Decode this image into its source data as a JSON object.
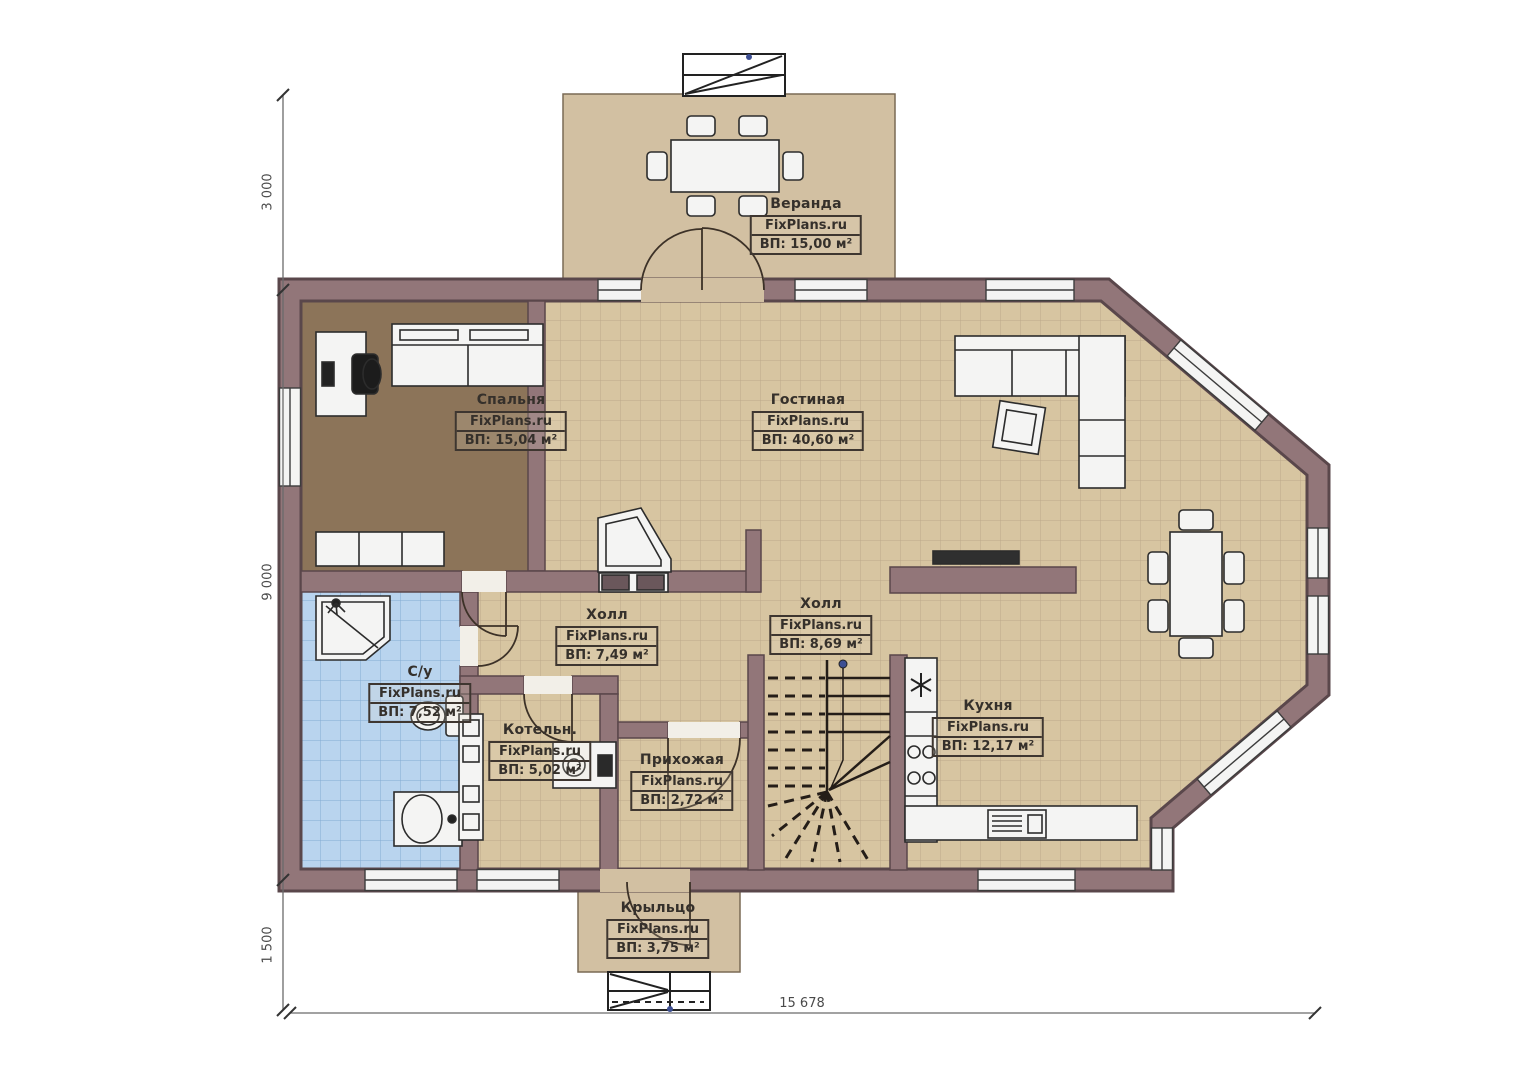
{
  "plan": {
    "brand": "FixPlans.ru",
    "rooms": [
      {
        "key": "veranda",
        "name": "Веранда",
        "area": "ВП: 15,00 м²"
      },
      {
        "key": "bedroom",
        "name": "Спальня",
        "area": "ВП: 15,04 м²"
      },
      {
        "key": "living_room",
        "name": "Гостиная",
        "area": "ВП: 40,60 м²"
      },
      {
        "key": "hall_small",
        "name": "Холл",
        "area": "ВП: 7,49 м²"
      },
      {
        "key": "hall_big",
        "name": "Холл",
        "area": "ВП: 8,69 м²"
      },
      {
        "key": "bathroom",
        "name": "С/у",
        "area": "ВП: 7,52 м²"
      },
      {
        "key": "boiler_room",
        "name": "Котельн.",
        "area": "ВП: 5,02 м²"
      },
      {
        "key": "entrance_hall",
        "name": "Прихожая",
        "area": "ВП: 2,72 м²"
      },
      {
        "key": "kitchen",
        "name": "Кухня",
        "area": "ВП: 12,17 м²"
      },
      {
        "key": "porch",
        "name": "Крыльцо",
        "area": "ВП: 3,75 м²"
      }
    ],
    "dimensions": {
      "left_top": "3 000",
      "left_middle": "9 000",
      "left_bottom": "1 500",
      "bottom_total": "15 678"
    },
    "colors": {
      "wall": "#927679",
      "wall_outline": "#5a474b",
      "floor_main": "#d7c5a1",
      "floor_bedroom": "#8c7459",
      "floor_bathroom": "#b9d4ee",
      "floor_outdoor": "#d2c0a2"
    }
  }
}
